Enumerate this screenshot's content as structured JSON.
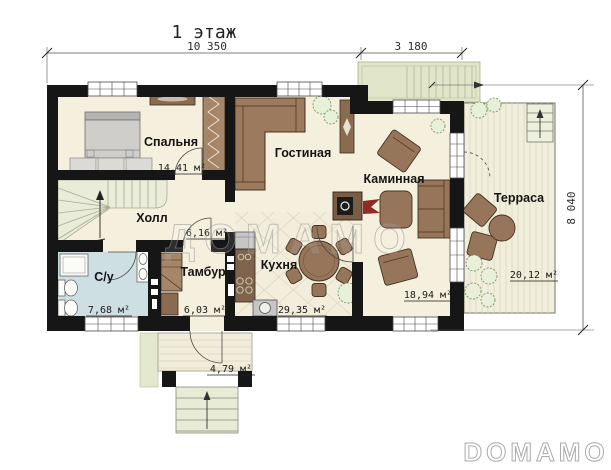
{
  "title": "1 этаж",
  "dimensions": {
    "width_main": "10 350",
    "width_right": "3 180",
    "height_right": "8 040"
  },
  "rooms": {
    "bedroom": {
      "label": "Спальня",
      "area": "14,41 м²"
    },
    "hall": {
      "label": "Холл",
      "area": "6,16 м²"
    },
    "bathroom": {
      "label": "С/у",
      "area": "7,68 м²"
    },
    "vestibule": {
      "label": "Тамбур",
      "area": "6,03 м²"
    },
    "living": {
      "label": "Гостиная"
    },
    "kitchen": {
      "label": "Кухня",
      "area": "29,35 м²"
    },
    "fireplace_room": {
      "label": "Каминная",
      "area": "18,94 м²"
    },
    "terrace": {
      "label": "Терраса",
      "area": "20,12 м²"
    },
    "porch": {
      "area": "4,79 м²"
    }
  },
  "watermarks": {
    "center": "ДОМАМО",
    "corner": "DOMAMO"
  },
  "palette": {
    "wall": "#161616",
    "floor_cream": "#f5f0dd",
    "floor_bath_blue": "#cddfe2",
    "terrace_floor": "#f1eedb",
    "exterior_green": "#e1e5ca",
    "furniture_brown": "#96755a",
    "furniture_dark_brown": "#7f634a",
    "bed_gray": "#cfcecb",
    "flame_red": "#8e2b25",
    "plant_green": "#7d9362"
  }
}
